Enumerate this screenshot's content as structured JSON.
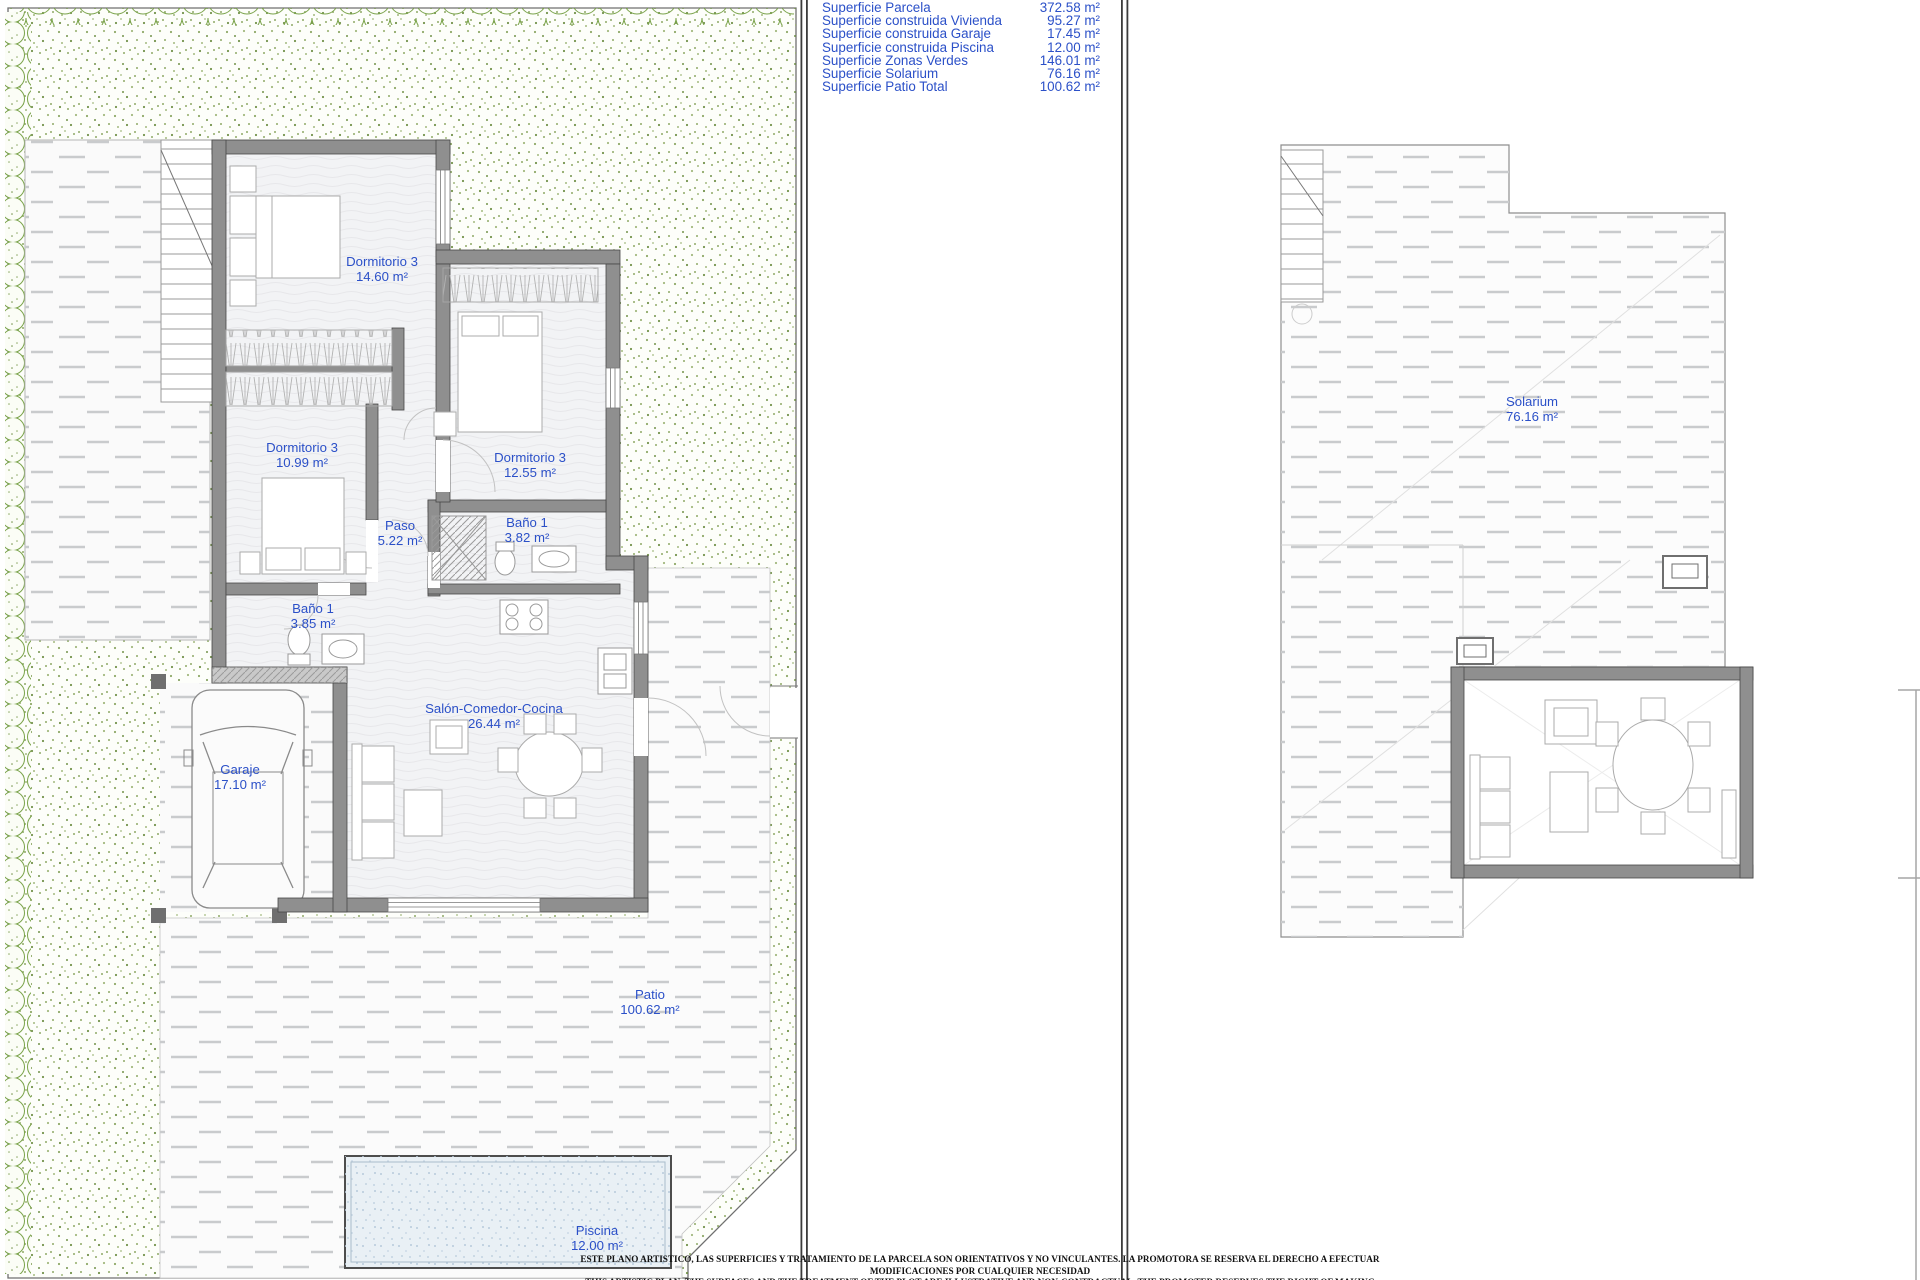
{
  "legend": {
    "rows": [
      {
        "label": "Superficie Parcela",
        "value": "372.58 m²"
      },
      {
        "label": "Superficie construida Vivienda",
        "value": "95.27 m²"
      },
      {
        "label": "Superficie construida Garaje",
        "value": "17.45 m²"
      },
      {
        "label": "Superficie construida Piscina",
        "value": "12.00 m²"
      },
      {
        "label": "Superficie Zonas Verdes",
        "value": "146.01 m²"
      },
      {
        "label": "Superficie Solarium",
        "value": "76.16 m²"
      },
      {
        "label": "Superficie Patio Total",
        "value": "100.62 m²"
      }
    ]
  },
  "floor_plan": {
    "rooms": [
      {
        "name": "Dormitorio 3",
        "area": "14.60 m²"
      },
      {
        "name": "Dormitorio 3",
        "area": "10.99 m²"
      },
      {
        "name": "Dormitorio 3",
        "area": "12.55 m²"
      },
      {
        "name": "Paso",
        "area": "5.22 m²"
      },
      {
        "name": "Baño 1",
        "area": "3.82 m²"
      },
      {
        "name": "Baño 1",
        "area": "3.85 m²"
      },
      {
        "name": "Salón-Comedor-Cocina",
        "area": "26.44 m²"
      },
      {
        "name": "Garaje",
        "area": "17.10 m²"
      },
      {
        "name": "Patio",
        "area": "100.62 m²"
      },
      {
        "name": "Piscina",
        "area": "12.00 m²"
      }
    ]
  },
  "roof_plan": {
    "rooms": [
      {
        "name": "Solarium",
        "area": "76.16 m²"
      }
    ]
  },
  "disclaimer": {
    "line_es": "ESTE PLANO ARTISTICO, LAS SUPERFICIES Y TRATAMIENTO DE LA PARCELA SON ORIENTATIVOS Y NO VINCULANTES. LA PROMOTORA SE RESERVA EL DERECHO A EFECTUAR MODIFICACIONES POR CUALQUIER NECESIDAD",
    "line_en": "THIS ARTISTIC PLAN, THE SURFACES AND THE TREATMENT OF THE PLOT ARE ILLUSTRATIVE AND NON-CONTRACTUAL. THE PROMOTER RESERVES THE RIGHT OF MAKING CHANGES DUE TO ANY NECESSITY"
  },
  "colors": {
    "label_blue": "#2b50c8",
    "wall_gray": "#8f8f8f",
    "hedge_green": "#7aa34a",
    "pool_fill": "#e9f0f5"
  }
}
